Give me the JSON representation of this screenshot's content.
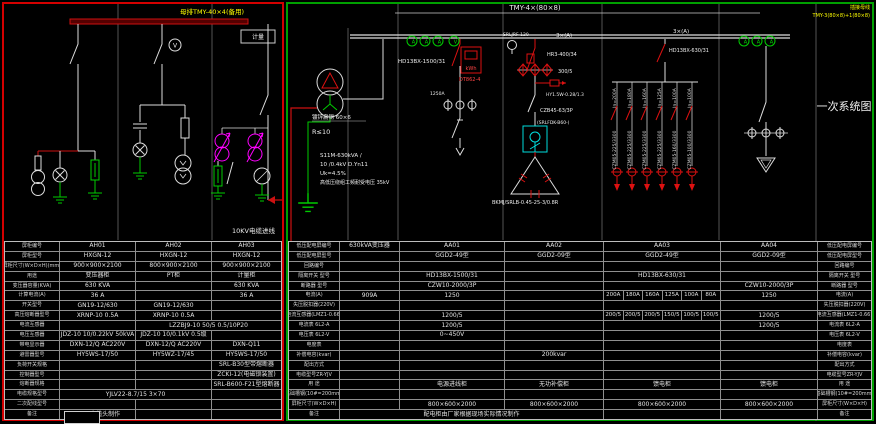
{
  "colors": {
    "hv_border": "#d40000",
    "lv_border": "#00a000",
    "bus_red": "#cc1111",
    "wire_white": "#dddddd",
    "ground_green": "#00cc00",
    "instrument_magenta": "#ff00ff",
    "contactor_cyan": "#00dddd",
    "label_yellow": "#ffff00",
    "device_red": "#dd1111"
  },
  "hv": {
    "bus_label": "母排TMY-40×4(备用)",
    "meter_box_label": "计量",
    "voltmeter": "V",
    "cable_label": "10KV电缆进线",
    "table": {
      "rows": [
        {
          "l": "屏柜编号",
          "c": [
            "AH01",
            "AH02",
            "AH03"
          ]
        },
        {
          "l": "屏柜型号",
          "c": [
            "HXGN-12",
            "HXGN-12",
            "HXGN-12"
          ]
        },
        {
          "l": "屏柜尺寸(W×D×H)(mm)",
          "c": [
            "900×900×2100",
            "800×900×2100",
            "900×900×2100"
          ]
        },
        {
          "l": "用途",
          "c": [
            "变压器柜",
            "PT柜",
            "计量柜"
          ]
        },
        {
          "l": "变压器容量(KVA)",
          "c": [
            "630 KVA",
            "",
            "630 KVA"
          ]
        },
        {
          "l": "计算电流(A)",
          "c": [
            "36 A",
            "",
            "36 A"
          ]
        },
        {
          "l": "开关型号",
          "c": [
            "GN19-12/630",
            "GN19-12/630",
            ""
          ]
        },
        {
          "l": "高压熔断器型号",
          "c": [
            "XRNP-10 0.5A",
            "XRNP-10 0.5A",
            ""
          ]
        },
        {
          "l": "电流互感器",
          "c": [
            "",
            [
              "LZZBJ9-10 50/5 0.5/10P20",
              2
            ]
          ]
        },
        {
          "l": "电压互感器",
          "c": [
            "JDZ-10 10/0.22kV 50kVA",
            "JDZ-10 10/0.1kV 0.5级",
            ""
          ]
        },
        {
          "l": "带电显示器",
          "c": [
            "DXN-12/Q AC220V",
            "DXN-12/Q AC220V",
            "DXN-Q11"
          ]
        },
        {
          "l": "避雷器型号",
          "c": [
            "HY5WS-17/50",
            "HY5WZ-17/45",
            "HY5WS-17/50"
          ]
        },
        {
          "l": "负荷开关规格",
          "c": [
            "",
            "",
            "SRL-B30型带熔断器"
          ]
        },
        {
          "l": "控制器型号",
          "c": [
            "",
            "",
            "ZCKI-12(电磁锁装置)"
          ]
        },
        {
          "l": "熔断器规格",
          "c": [
            "",
            "",
            "SRL-B600-F21型熔断器"
          ]
        },
        {
          "l": "电缆规格型号",
          "c": [
            [
              "YJLV22-8.7/15 3×70",
              2
            ],
            ""
          ]
        },
        {
          "l": "二次配线型号",
          "c": [
            "",
            "",
            ""
          ]
        },
        {
          "l": "备注",
          "c": [
            "10kV电缆头制作",
            "",
            ""
          ]
        }
      ]
    }
  },
  "lv": {
    "bus_label": "TMY-4×(80×8)",
    "busway_line1": "插接母线",
    "busway_line2": "TMY-3(80×8)+1(80×8)",
    "title": "一次系统图",
    "ground_steel": "镀锌扁钢 60×6",
    "ground_r": "R≤10",
    "tx_spec": [
      "S11M-630kVA /",
      "10 /0.4kV D.Yn11",
      "Uk=4.5%",
      "高低压绕组工频耐受电压 35kV"
    ],
    "meters": {
      "a": "A",
      "v": "V"
    },
    "aa01": {
      "knife": "HD13BX-1500/31",
      "kwh": "kWh",
      "meter": "DT862-4",
      "breaker_note": "1250A"
    },
    "aa02": {
      "fuse_label": "SRLJRF-120",
      "ct_count": "3×(A)",
      "fuse_switch": "HR3-400/34",
      "ct_ratio": "300/5",
      "arrester": "HY1.5W-0.28/1.3",
      "breaker": "CZB45-63/3P",
      "contactor": "(SRLFDK-B60-)",
      "capacitor": "BKMJ/SRLB-0.45-25-3/0.8R"
    },
    "aa03": {
      "ct_count": "3×(A)",
      "knife": "HD13BX-630/31",
      "feeders": [
        {
          "rated": "In=200A",
          "breaker": "CZM05-225/3300"
        },
        {
          "rated": "In=180A",
          "breaker": "CZM05-225/3300"
        },
        {
          "rated": "In=160A",
          "breaker": "CZM05-225/3300"
        },
        {
          "rated": "In=125A",
          "breaker": "CZM05-225/3300"
        },
        {
          "rated": "In=100A",
          "breaker": "CZM05-160/3300"
        },
        {
          "rated": "In=100A",
          "breaker": "CZM05-100/3300"
        }
      ]
    },
    "table": {
      "rows": [
        {
          "l": "低压配电屏编号",
          "c": [
            "630kVA变压器",
            "AA01",
            "AA02",
            "AA03",
            "AA04"
          ],
          "r": "低压配电屏编号"
        },
        {
          "l": "低压配电屏型号",
          "c": [
            "",
            "GGD2-49型",
            "GGD2-09型",
            "GGD2-49型",
            "GGD2-09型"
          ],
          "r": "低压配电屏型号"
        },
        {
          "l": "回路编号",
          "c": [
            "",
            "",
            "",
            "",
            ""
          ],
          "r": "回路编号"
        },
        {
          "l": "隔离开关 型号",
          "c": [
            "",
            "HD13BX-1500/31",
            "",
            "HD13BX-630/31",
            ""
          ],
          "r": "隔离开关 型号"
        },
        {
          "l": "断路器 型号",
          "c": [
            "",
            "CZW10-2000/3P",
            "",
            "",
            "CZW10-2000/3P"
          ],
          "r": "断路器 型号"
        },
        {
          "l": "电流(A)",
          "c": [
            "909A",
            "1250",
            "",
            {
              "sub": [
                "200A",
                "180A",
                "160A",
                "125A",
                "100A",
                "80A"
              ]
            },
            "1250"
          ],
          "r": "电流(A)"
        },
        {
          "l": "失压脱扣器(220V)",
          "c": [
            "",
            "",
            "",
            "",
            ""
          ],
          "r": "失压脱扣器(220V)"
        },
        {
          "l": "电流互感器(LMZ1-0.66)",
          "c": [
            "",
            "1200/5",
            "",
            {
              "sub": [
                "200/5",
                "200/5",
                "200/5",
                "150/5",
                "100/5",
                "100/5"
              ]
            },
            "1200/5"
          ],
          "r": "电流互感器(LMZ1-0.66)"
        },
        {
          "l": "电流表 6L2-A",
          "c": [
            "",
            "1200/5",
            "",
            "",
            "1200/5"
          ],
          "r": "电流表 6L2-A"
        },
        {
          "l": "电压表 6L2-V",
          "c": [
            "",
            "0~450V",
            "",
            "",
            ""
          ],
          "r": "电压表 6L2-V"
        },
        {
          "l": "电度表",
          "c": [
            "",
            "",
            "",
            "",
            ""
          ],
          "r": "电度表"
        },
        {
          "l": "补偿电容(kvar)",
          "c": [
            "",
            "",
            "200kvar",
            "",
            ""
          ],
          "r": "补偿电容(kvar)"
        },
        {
          "l": "配出方式",
          "c": [
            "",
            "",
            "",
            "",
            ""
          ],
          "r": "配出方式"
        },
        {
          "l": "电缆型号ZR-YJV",
          "c": [
            "",
            "",
            "",
            "",
            ""
          ],
          "r": "电缆型号ZR-YJV"
        },
        {
          "l": "用 途",
          "c": [
            "",
            "电源进线柜",
            "无功补偿柜",
            "馈电柜",
            "馈电柜"
          ],
          "r": "用 途"
        },
        {
          "l": "基础槽钢(10#=200mm)",
          "c": [
            "",
            "",
            "",
            "",
            ""
          ],
          "r": "基础槽钢(10#=200mm)"
        },
        {
          "l": "屏柜尺寸(W×D×H)",
          "c": [
            "",
            "800×600×2000",
            "800×600×2000",
            "800×600×2000",
            "800×600×2000"
          ],
          "r": "屏柜尺寸(W×D×H)"
        },
        {
          "l": "备注",
          "c": [
            [
              "配电柜由厂家根据现场实际情况制作",
              3
            ],
            "",
            ""
          ],
          "r": "备注"
        }
      ]
    }
  }
}
